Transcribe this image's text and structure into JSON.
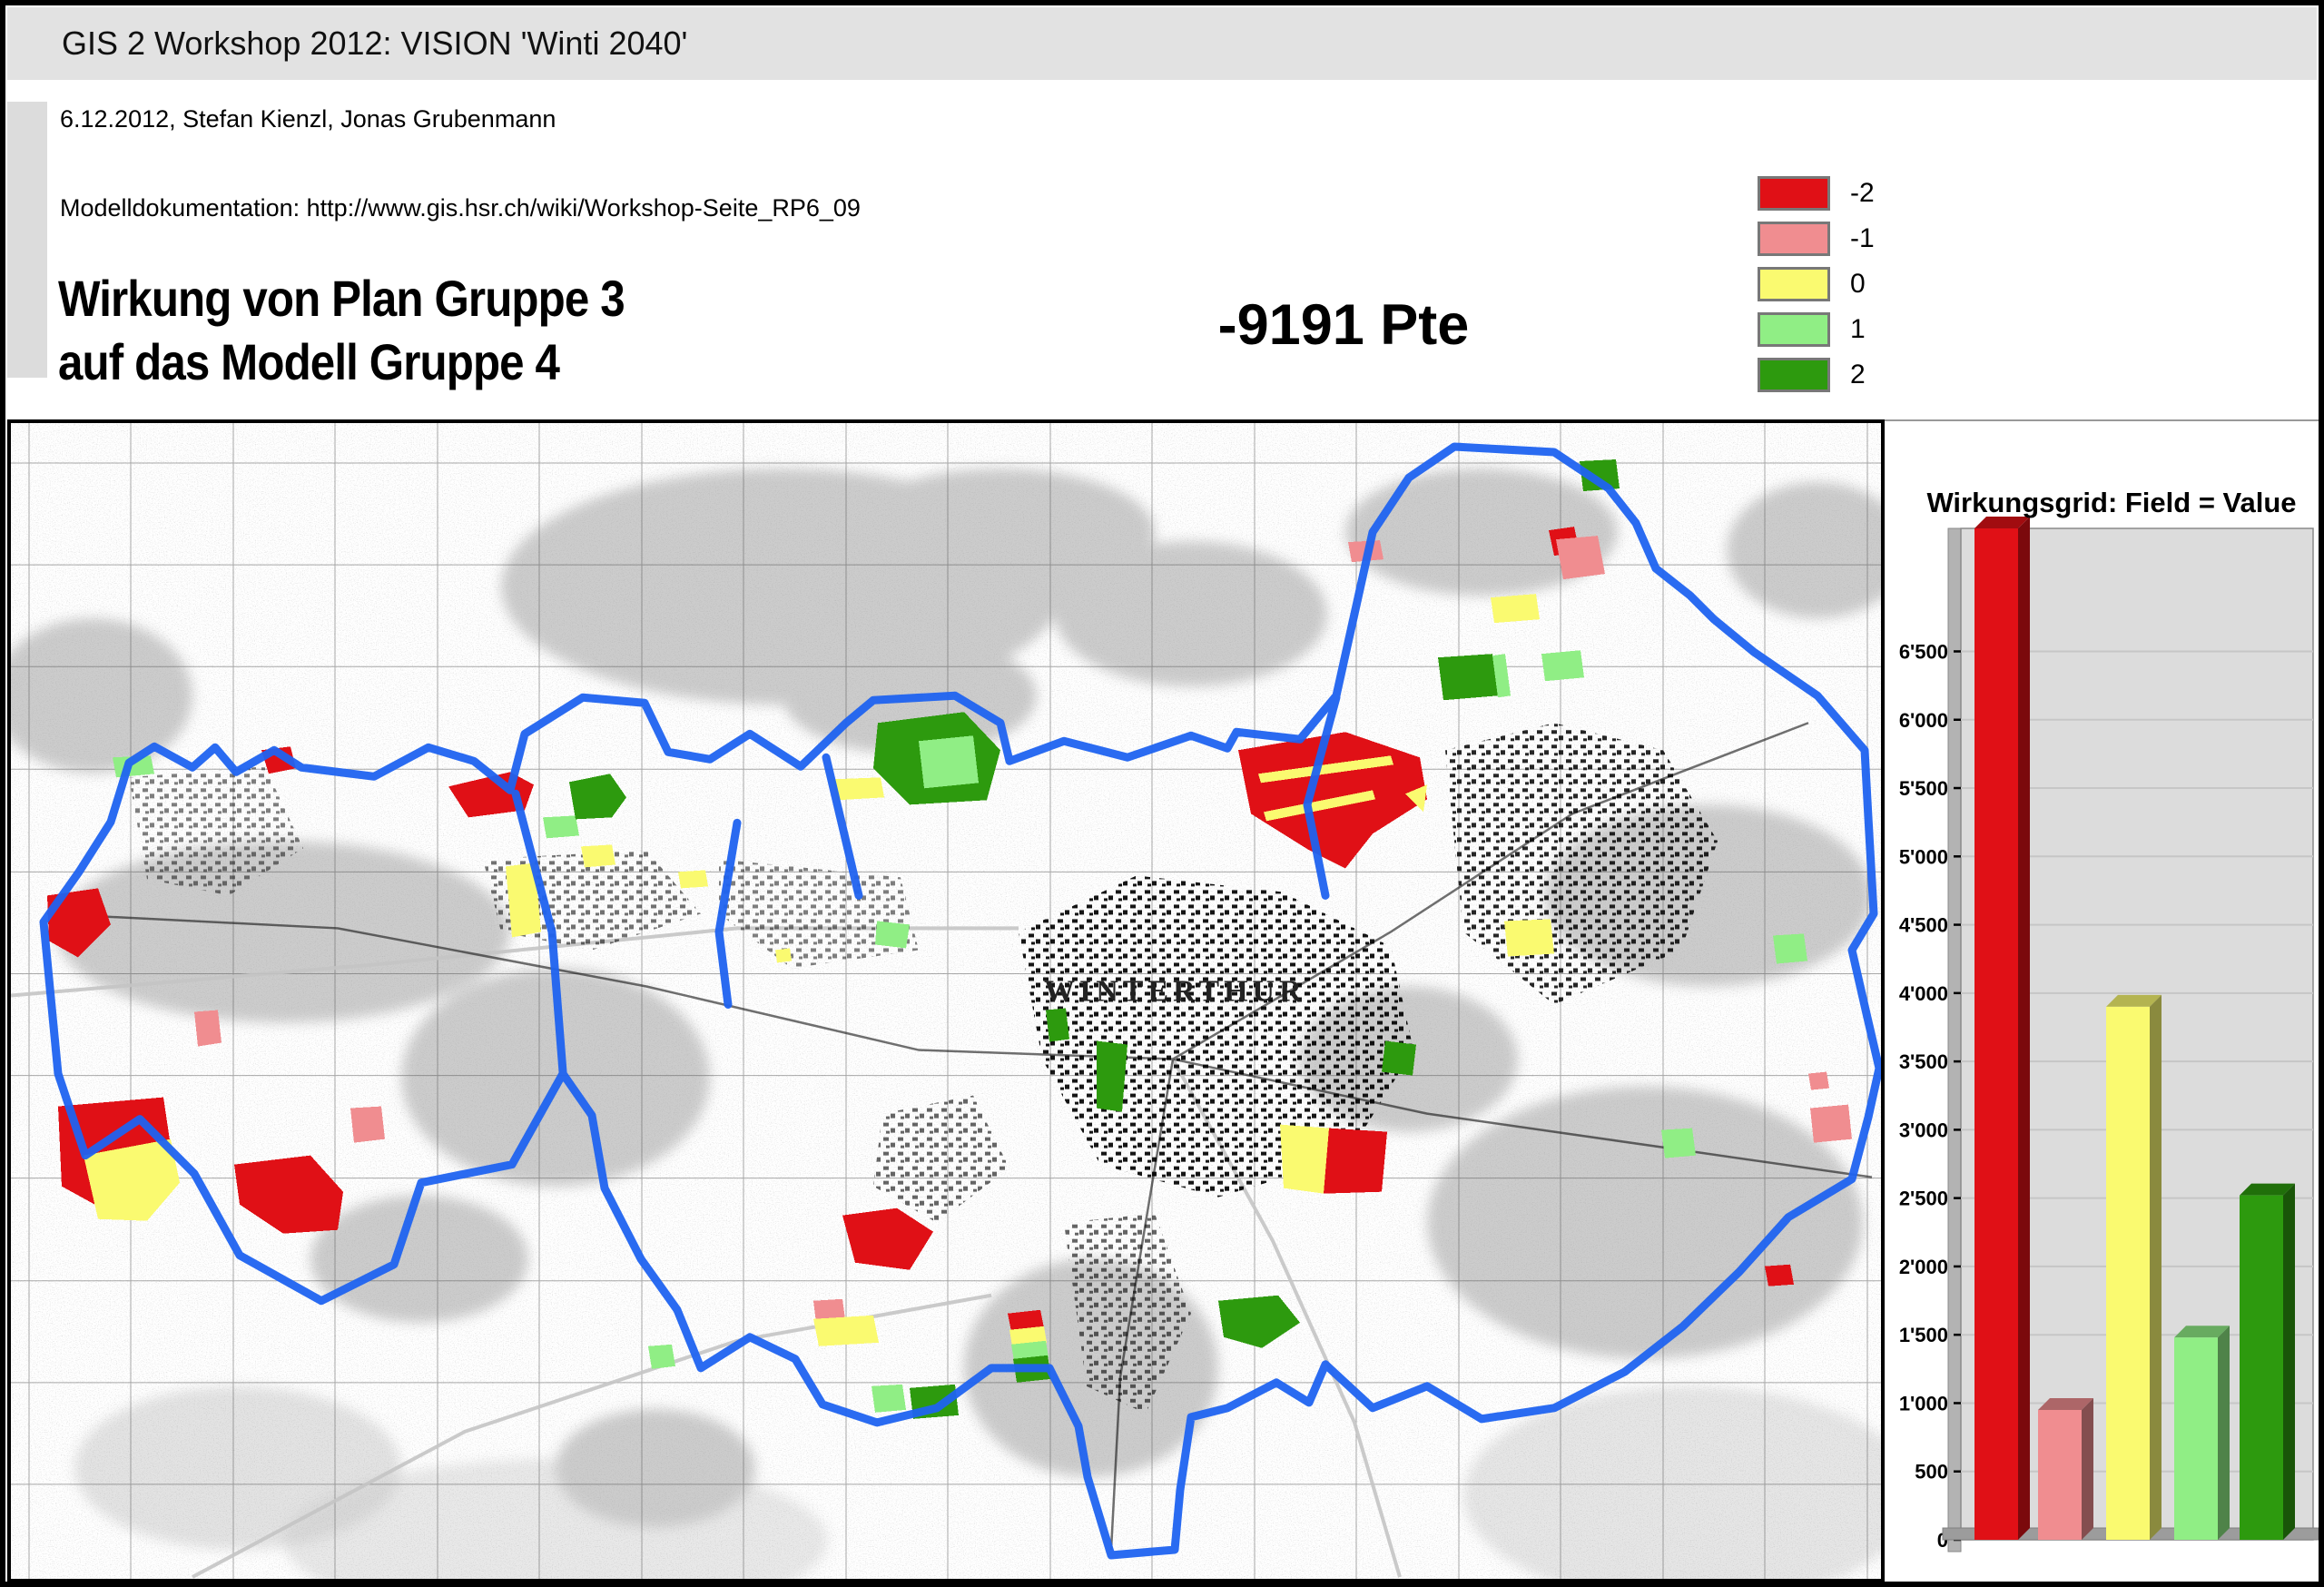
{
  "header": {
    "title": "GIS 2 Workshop 2012: VISION 'Winti 2040'",
    "subtitle": "6.12.2012, Stefan Kienzl, Jonas Grubenmann",
    "doc_line": "Modelldokumentation: http://www.gis.hsr.ch/wiki/Workshop-Seite_RP6_09",
    "main_title_line1": "Wirkung von Plan Gruppe 3",
    "main_title_line2": "auf das Modell Gruppe 4",
    "score": "-9191 Pte"
  },
  "legend": {
    "items": [
      {
        "label": "-2",
        "color": "#e01016"
      },
      {
        "label": "-1",
        "color": "#f08d90"
      },
      {
        "label": "0",
        "color": "#fafa70"
      },
      {
        "label": "1",
        "color": "#90ee85"
      },
      {
        "label": "2",
        "color": "#2d9a0e"
      }
    ]
  },
  "map": {
    "label": "WINTERTHUR",
    "boundary_color": "#1f63f0"
  },
  "chart_data": {
    "type": "bar",
    "title": "Wirkungsgrid: Field = Value",
    "categories": [
      "-2",
      "-1",
      "0",
      "1",
      "2"
    ],
    "values": [
      7400,
      950,
      3900,
      1480,
      2520
    ],
    "colors": [
      "#e01016",
      "#f08d90",
      "#fafa70",
      "#90ee85",
      "#2d9a0e"
    ],
    "xlabel": "",
    "ylabel": "",
    "ylim": [
      0,
      7400
    ],
    "ytick_step": 500,
    "ytick_labels": [
      "0",
      "500",
      "1'000",
      "1'500",
      "2'000",
      "2'500",
      "3'000",
      "3'500",
      "4'000",
      "4'500",
      "5'000",
      "5'500",
      "6'000",
      "6'500",
      "7'000"
    ],
    "grid": true,
    "legend_position": "none",
    "plot_bg": "#dcdcdc"
  }
}
